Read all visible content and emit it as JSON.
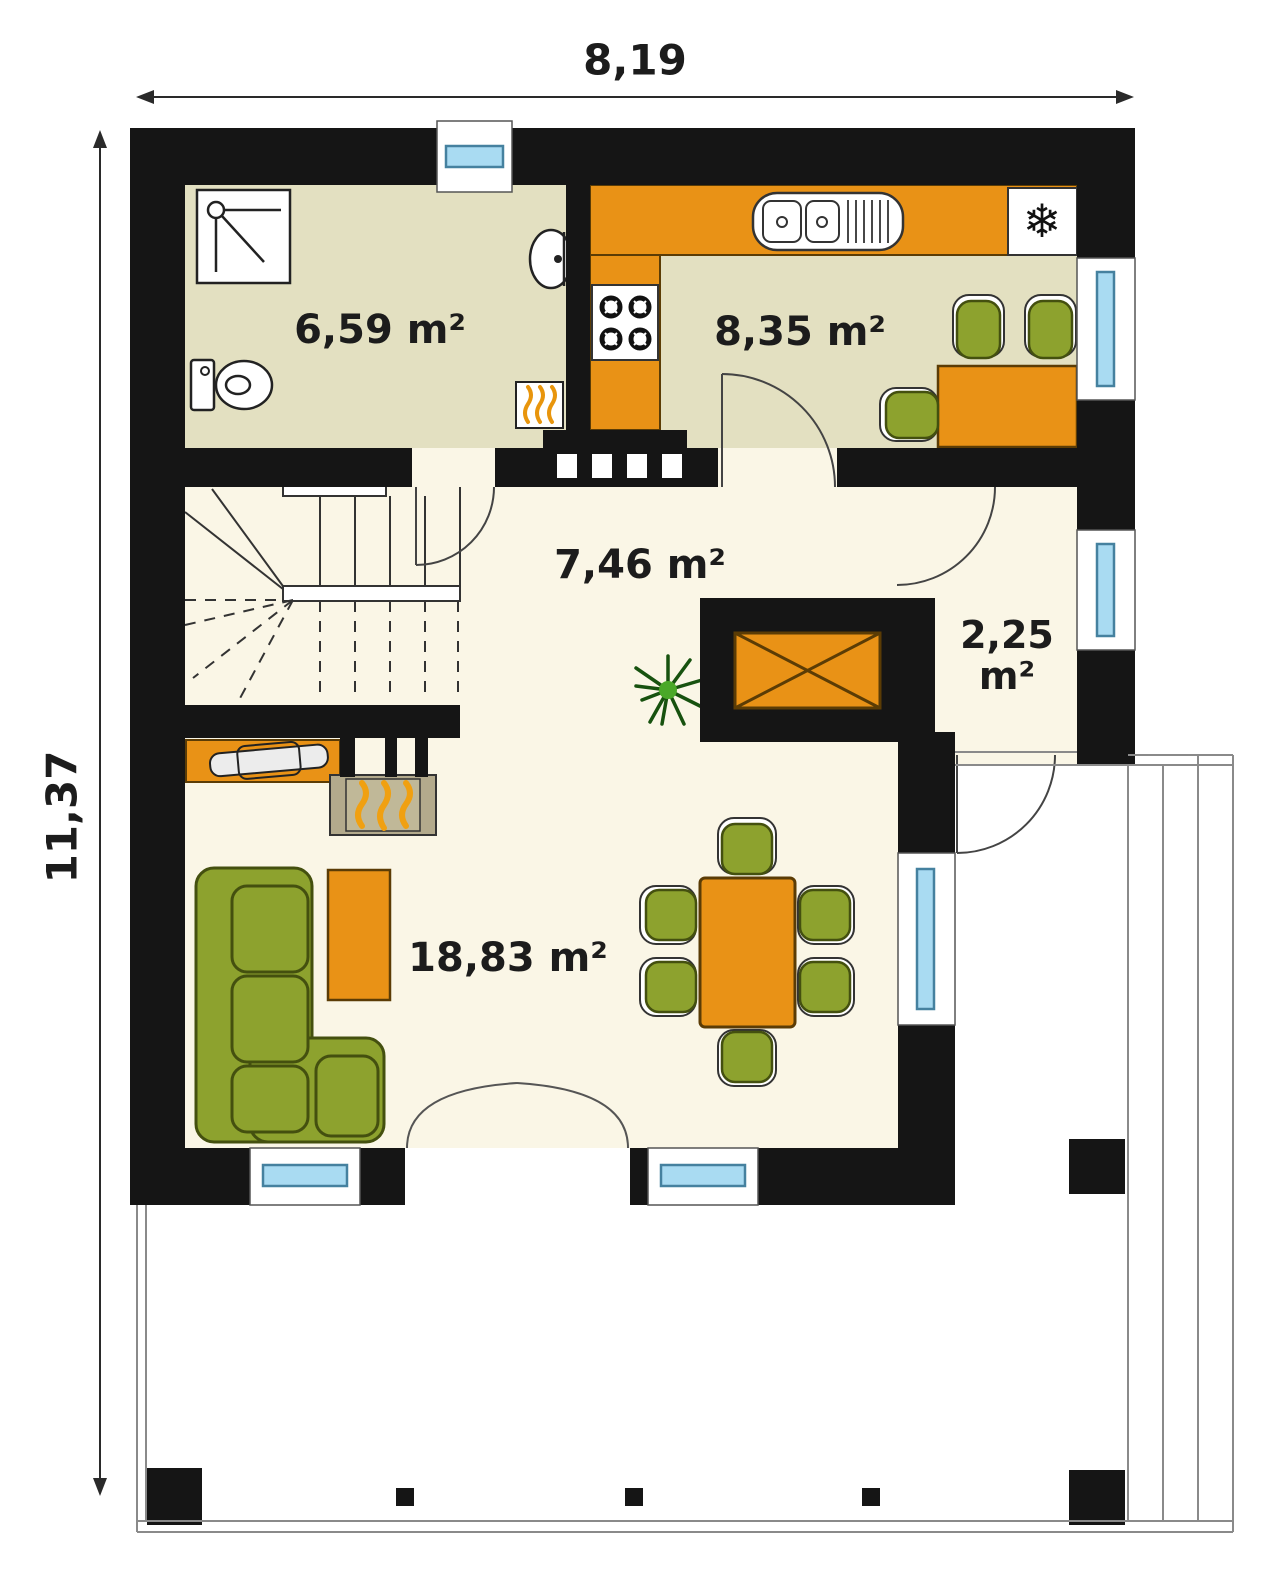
{
  "plan": {
    "type": "house-ground-floor-plan",
    "dimensions": {
      "width_label": "8,19",
      "height_label": "11,37"
    },
    "rooms": {
      "bathroom": {
        "area": "6,59 m²"
      },
      "kitchen": {
        "area": "8,35 m²"
      },
      "hall": {
        "area": "7,46 m²"
      },
      "vestibule": {
        "area_value": "2,25",
        "area_unit": "m²"
      },
      "living_room": {
        "area": "18,83 m²"
      }
    },
    "icons": {
      "fridge_snowflake": "❄"
    },
    "colors": {
      "wall": "#151515",
      "floor_bathroom_kitchen": "#e3e0c1",
      "floor_hall_living": "#faf6e6",
      "furniture_orange": "#e99216",
      "furniture_green": "#8da22e",
      "window_glass": "#a9dbf2",
      "firebox_tan": "#b3aa8c",
      "flame_orange": "#f0a011",
      "terrace_line": "#8a8a8a"
    }
  }
}
